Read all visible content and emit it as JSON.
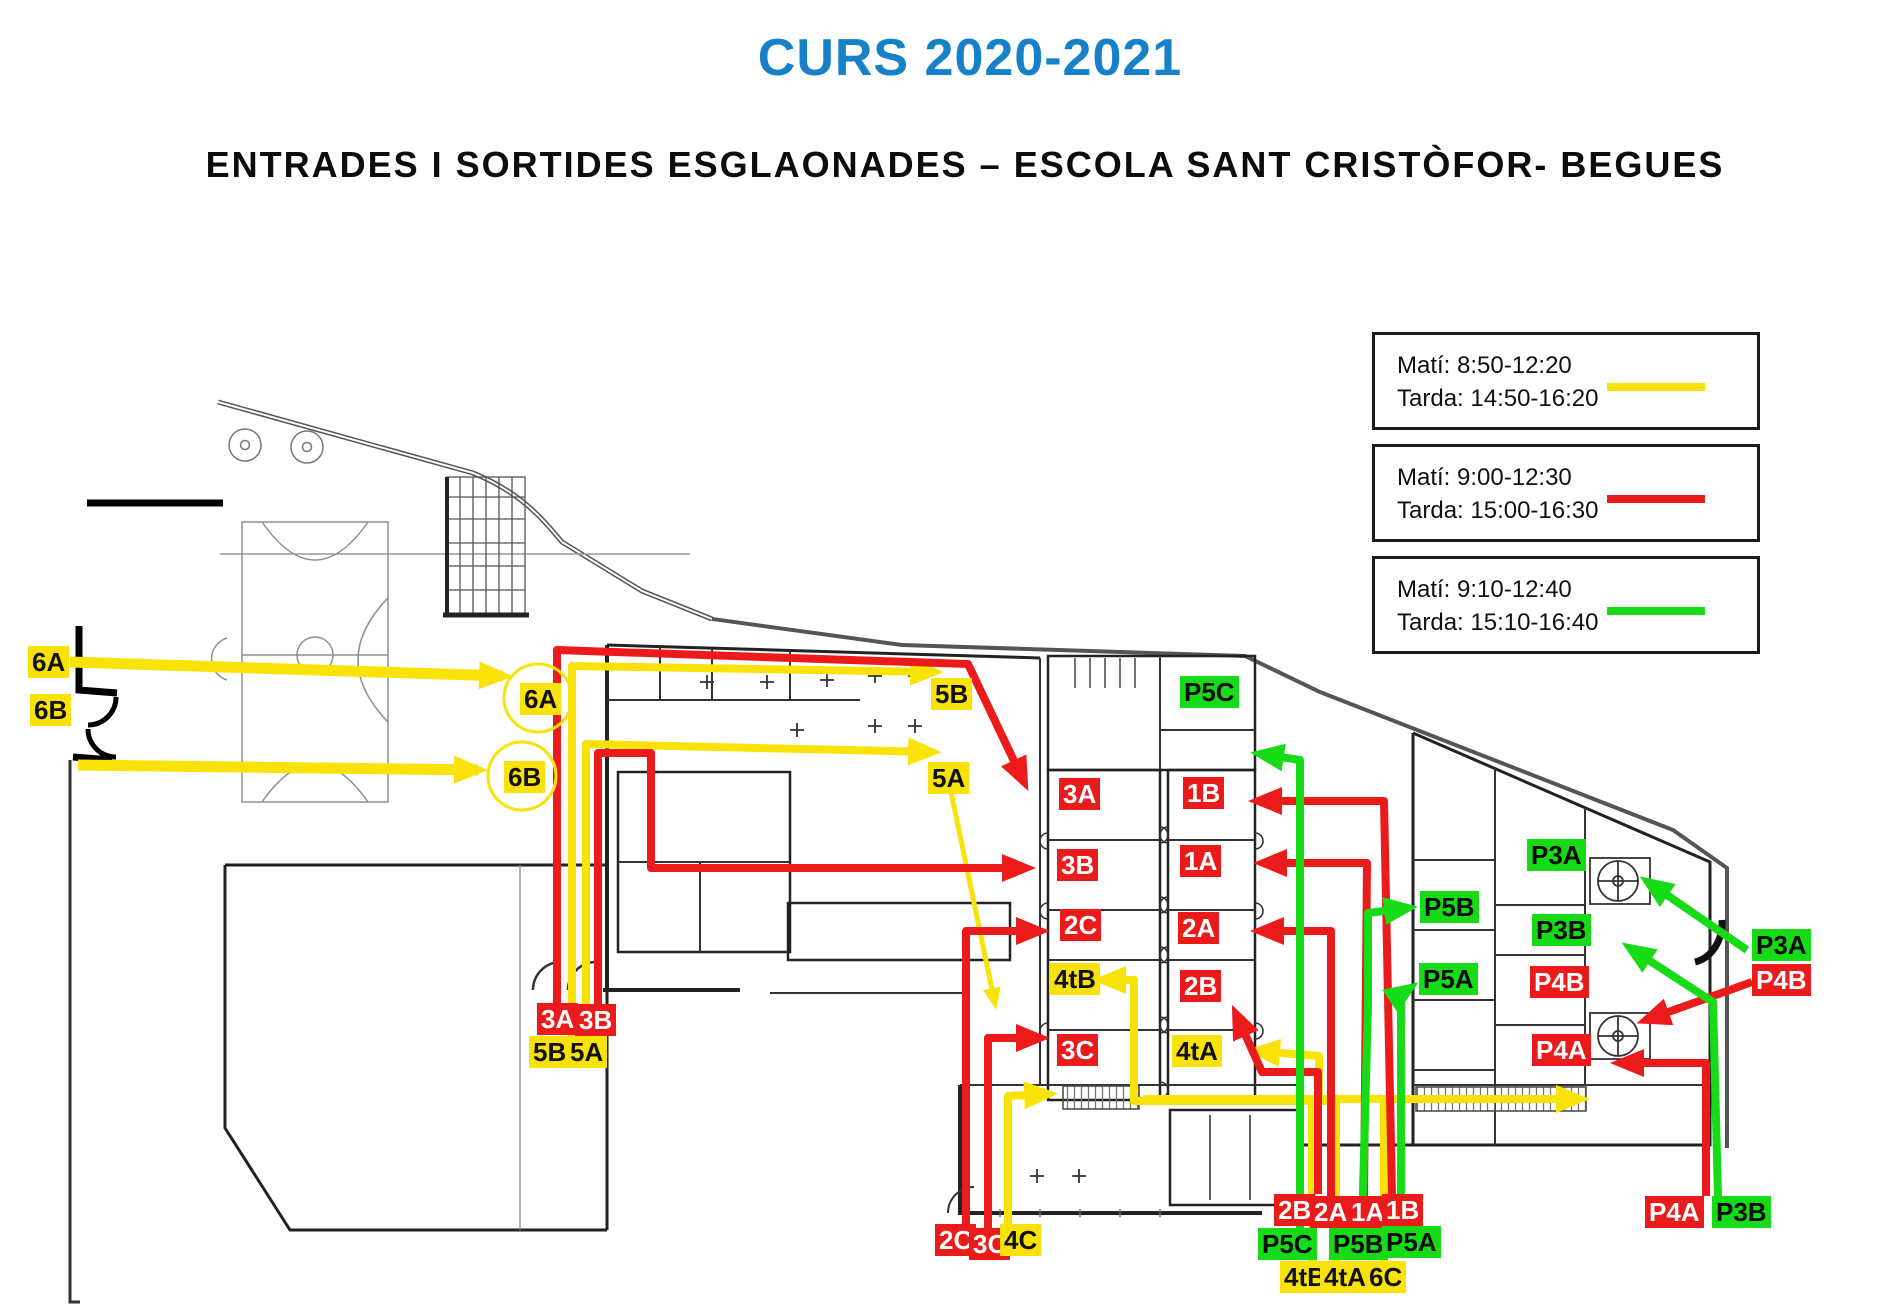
{
  "title": "CURS 2020-2021",
  "subtitle": "ENTRADES I SORTIDES ESGLAONADES – ESCOLA SANT CRISTÒFOR- BEGUES",
  "colors": {
    "title_blue": "#1681C8",
    "yellow": "#F8E208",
    "red": "#EB1B1B",
    "green": "#17DB17",
    "label_red_text": "#FFFFFF",
    "label_dark_text": "#111111"
  },
  "legend": {
    "items": [
      {
        "mati": "Matí: 8:50-12:20",
        "tarda": "Tarda: 14:50-16:20",
        "color": "yellow"
      },
      {
        "mati": "Matí: 9:00-12:30",
        "tarda": "Tarda: 15:00-16:30",
        "color": "red"
      },
      {
        "mati": "Matí: 9:10-12:40",
        "tarda": "Tarda: 15:10-16:40",
        "color": "green"
      }
    ]
  },
  "map": {
    "entry_circles": [
      {
        "label": "6A",
        "cx": 538,
        "cy": 698,
        "r": 34
      },
      {
        "label": "6B",
        "cx": 522,
        "cy": 776,
        "r": 34
      }
    ],
    "labels": [
      {
        "id": "street-6A",
        "text": "6A",
        "color": "yellow",
        "x": 28,
        "y": 646
      },
      {
        "id": "street-6B",
        "text": "6B",
        "color": "yellow",
        "x": 30,
        "y": 694
      },
      {
        "id": "top-5B",
        "text": "5B",
        "color": "yellow",
        "x": 931,
        "y": 678
      },
      {
        "id": "top-5A",
        "text": "5A",
        "color": "yellow",
        "x": 928,
        "y": 762
      },
      {
        "id": "room-P5C",
        "text": "P5C",
        "color": "green",
        "x": 1180,
        "y": 676
      },
      {
        "id": "room-3A",
        "text": "3A",
        "color": "red",
        "x": 1059,
        "y": 778
      },
      {
        "id": "room-1B",
        "text": "1B",
        "color": "red",
        "x": 1183,
        "y": 777
      },
      {
        "id": "room-3B",
        "text": "3B",
        "color": "red",
        "x": 1057,
        "y": 849
      },
      {
        "id": "room-1A",
        "text": "1A",
        "color": "red",
        "x": 1180,
        "y": 845
      },
      {
        "id": "room-2C",
        "text": "2C",
        "color": "red",
        "x": 1060,
        "y": 909
      },
      {
        "id": "room-2A",
        "text": "2A",
        "color": "red",
        "x": 1178,
        "y": 912
      },
      {
        "id": "room-4tB",
        "text": "4tB",
        "color": "yellow",
        "x": 1050,
        "y": 963
      },
      {
        "id": "room-2B",
        "text": "2B",
        "color": "red",
        "x": 1180,
        "y": 970
      },
      {
        "id": "room-3C",
        "text": "3C",
        "color": "red",
        "x": 1057,
        "y": 1034
      },
      {
        "id": "room-4tA",
        "text": "4tA",
        "color": "yellow",
        "x": 1172,
        "y": 1035
      },
      {
        "id": "room-P5B",
        "text": "P5B",
        "color": "green",
        "x": 1420,
        "y": 891
      },
      {
        "id": "room-P5A",
        "text": "P5A",
        "color": "green",
        "x": 1419,
        "y": 963
      },
      {
        "id": "room-P3A",
        "text": "P3A",
        "color": "green",
        "x": 1527,
        "y": 839
      },
      {
        "id": "room-P3B",
        "text": "P3B",
        "color": "green",
        "x": 1532,
        "y": 914
      },
      {
        "id": "room-P4B",
        "text": "P4B",
        "color": "red",
        "x": 1530,
        "y": 966
      },
      {
        "id": "room-P4A",
        "text": "P4A",
        "color": "red",
        "x": 1532,
        "y": 1034
      },
      {
        "id": "east-P3A",
        "text": "P3A",
        "color": "green",
        "x": 1752,
        "y": 929
      },
      {
        "id": "east-P4B",
        "text": "P4B",
        "color": "red",
        "x": 1752,
        "y": 964
      },
      {
        "id": "west-3A",
        "text": "3A",
        "color": "red",
        "x": 537,
        "y": 1003
      },
      {
        "id": "west-3B",
        "text": "3B",
        "color": "red",
        "x": 575,
        "y": 1004
      },
      {
        "id": "west-5B",
        "text": "5B",
        "color": "yellow",
        "x": 529,
        "y": 1036
      },
      {
        "id": "west-5A",
        "text": "5A",
        "color": "yellow",
        "x": 566,
        "y": 1036
      },
      {
        "id": "south-2C",
        "text": "2C",
        "color": "red",
        "x": 935,
        "y": 1224
      },
      {
        "id": "south-3C",
        "text": "3C",
        "color": "red",
        "x": 969,
        "y": 1228
      },
      {
        "id": "south-4C",
        "text": "4C",
        "color": "yellow",
        "x": 1000,
        "y": 1224
      },
      {
        "id": "south-2B",
        "text": "2B",
        "color": "red",
        "x": 1274,
        "y": 1194
      },
      {
        "id": "south-2A",
        "text": "2A",
        "color": "red",
        "x": 1310,
        "y": 1196
      },
      {
        "id": "south-1A",
        "text": "1A",
        "color": "red",
        "x": 1347,
        "y": 1196
      },
      {
        "id": "south-1B",
        "text": "1B",
        "color": "red",
        "x": 1382,
        "y": 1194
      },
      {
        "id": "south-P5C",
        "text": "P5C",
        "color": "green",
        "x": 1258,
        "y": 1228
      },
      {
        "id": "south-P5B",
        "text": "P5B",
        "color": "green",
        "x": 1329,
        "y": 1228
      },
      {
        "id": "south-P5A",
        "text": "P5A",
        "color": "green",
        "x": 1382,
        "y": 1226
      },
      {
        "id": "south-4tB",
        "text": "4tB",
        "color": "yellow",
        "x": 1280,
        "y": 1261
      },
      {
        "id": "south-4tA",
        "text": "4tA",
        "color": "yellow",
        "x": 1320,
        "y": 1261
      },
      {
        "id": "south-6C",
        "text": "6C",
        "color": "yellow",
        "x": 1365,
        "y": 1261
      },
      {
        "id": "south-P4A",
        "text": "P4A",
        "color": "red",
        "x": 1645,
        "y": 1196
      },
      {
        "id": "south-P3B",
        "text": "P3B",
        "color": "green",
        "x": 1712,
        "y": 1196
      }
    ],
    "routes": [
      {
        "id": "6A-street",
        "color": "yellow",
        "width": 11,
        "arrow": true,
        "points": [
          [
            70,
            662
          ],
          [
            503,
            676
          ]
        ]
      },
      {
        "id": "6B-street",
        "color": "yellow",
        "width": 11,
        "arrow": true,
        "points": [
          [
            78,
            765
          ],
          [
            478,
            770
          ]
        ]
      },
      {
        "id": "5B",
        "color": "yellow",
        "width": 8,
        "arrow": true,
        "points": [
          [
            572,
            1036
          ],
          [
            572,
            666
          ],
          [
            934,
            672
          ]
        ]
      },
      {
        "id": "5A",
        "color": "yellow",
        "width": 8,
        "arrow": true,
        "points": [
          [
            586,
            1038
          ],
          [
            586,
            744
          ],
          [
            932,
            752
          ]
        ]
      },
      {
        "id": "5A-patio",
        "color": "yellow",
        "width": 5,
        "arrow": true,
        "small": true,
        "points": [
          [
            951,
            792
          ],
          [
            995,
            1004
          ]
        ]
      },
      {
        "id": "4C",
        "color": "yellow",
        "width": 8,
        "arrow": true,
        "points": [
          [
            1008,
            1224
          ],
          [
            1008,
            1096
          ],
          [
            1048,
            1094
          ]
        ]
      },
      {
        "id": "6C-corridor",
        "color": "yellow",
        "width": 8,
        "arrow": true,
        "points": [
          [
            1143,
            1099
          ],
          [
            1580,
            1099
          ]
        ]
      },
      {
        "id": "6C-up",
        "color": "yellow",
        "width": 8,
        "arrow": false,
        "points": [
          [
            1384,
            1261
          ],
          [
            1384,
            1097
          ]
        ]
      },
      {
        "id": "4tB",
        "color": "yellow",
        "width": 8,
        "arrow": true,
        "points": [
          [
            1312,
            1261
          ],
          [
            1312,
            1101
          ],
          [
            1134,
            1101
          ],
          [
            1134,
            980
          ],
          [
            1102,
            980
          ]
        ]
      },
      {
        "id": "4tA",
        "color": "yellow",
        "width": 8,
        "arrow": true,
        "points": [
          [
            1336,
            1261
          ],
          [
            1336,
            1101
          ],
          [
            1319,
            1101
          ],
          [
            1319,
            1056
          ],
          [
            1256,
            1051
          ]
        ]
      },
      {
        "id": "3A",
        "color": "red",
        "width": 8,
        "arrow": true,
        "points": [
          [
            557,
            1004
          ],
          [
            557,
            650
          ],
          [
            968,
            664
          ],
          [
            1024,
            782
          ]
        ]
      },
      {
        "id": "3B",
        "color": "red",
        "width": 8,
        "arrow": true,
        "points": [
          [
            598,
            1032
          ],
          [
            598,
            753
          ],
          [
            651,
            753
          ],
          [
            651,
            868
          ],
          [
            1026,
            868
          ]
        ]
      },
      {
        "id": "2C",
        "color": "red",
        "width": 8,
        "arrow": true,
        "points": [
          [
            966,
            1224
          ],
          [
            966,
            931
          ],
          [
            1040,
            931
          ]
        ]
      },
      {
        "id": "3C",
        "color": "red",
        "width": 8,
        "arrow": true,
        "points": [
          [
            988,
            1229
          ],
          [
            988,
            1038
          ],
          [
            1040,
            1038
          ]
        ]
      },
      {
        "id": "2B",
        "color": "red",
        "width": 8,
        "arrow": true,
        "points": [
          [
            1318,
            1194
          ],
          [
            1318,
            1072
          ],
          [
            1262,
            1072
          ],
          [
            1236,
            1014
          ]
        ]
      },
      {
        "id": "2A",
        "color": "red",
        "width": 8,
        "arrow": true,
        "points": [
          [
            1331,
            1196
          ],
          [
            1331,
            931
          ],
          [
            1260,
            931
          ]
        ]
      },
      {
        "id": "1A",
        "color": "red",
        "width": 8,
        "arrow": true,
        "points": [
          [
            1364,
            1196
          ],
          [
            1367,
            863
          ],
          [
            1263,
            863
          ]
        ]
      },
      {
        "id": "1B",
        "color": "red",
        "width": 8,
        "arrow": true,
        "points": [
          [
            1392,
            1194
          ],
          [
            1384,
            801
          ],
          [
            1258,
            801
          ]
        ]
      },
      {
        "id": "P4A",
        "color": "red",
        "width": 8,
        "arrow": true,
        "points": [
          [
            1706,
            1196
          ],
          [
            1706,
            1063
          ],
          [
            1620,
            1063
          ]
        ]
      },
      {
        "id": "P4B",
        "color": "red",
        "width": 8,
        "arrow": true,
        "points": [
          [
            1752,
            982
          ],
          [
            1646,
            1020
          ]
        ]
      },
      {
        "id": "P5C",
        "color": "green",
        "width": 8,
        "arrow": true,
        "points": [
          [
            1300,
            1228
          ],
          [
            1300,
            760
          ],
          [
            1260,
            754
          ]
        ]
      },
      {
        "id": "P5B",
        "color": "green",
        "width": 8,
        "arrow": true,
        "points": [
          [
            1362,
            1228
          ],
          [
            1368,
            1005
          ],
          [
            1368,
            913
          ],
          [
            1408,
            908
          ]
        ]
      },
      {
        "id": "P5A",
        "color": "green",
        "width": 8,
        "arrow": true,
        "points": [
          [
            1401,
            1228
          ],
          [
            1401,
            994
          ],
          [
            1410,
            988
          ]
        ]
      },
      {
        "id": "P3B",
        "color": "green",
        "width": 8,
        "arrow": true,
        "points": [
          [
            1718,
            1196
          ],
          [
            1713,
            1002
          ],
          [
            1630,
            948
          ]
        ]
      },
      {
        "id": "P3A",
        "color": "green",
        "width": 8,
        "arrow": true,
        "points": [
          [
            1747,
            950
          ],
          [
            1648,
            882
          ]
        ]
      }
    ]
  }
}
